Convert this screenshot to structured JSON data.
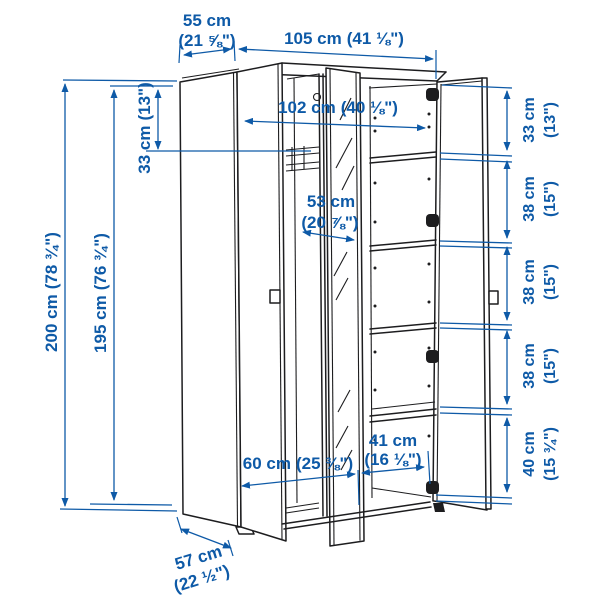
{
  "diagram": {
    "kind": "wardrobe-dimension-diagram",
    "background": "#ffffff",
    "dimension_color": "#0e5aa7",
    "outline_color": "#1d1d1f"
  },
  "dimensions": {
    "top_depth": {
      "cm": "55 cm",
      "inches": "(21 ⅝\")"
    },
    "overall_width": {
      "cm": "105 cm",
      "inches": "(41 ⅛\")"
    },
    "interior_width": {
      "cm": "102 cm",
      "inches": "(40 ⅛\")"
    },
    "top_section_left": {
      "cm": "33 cm",
      "inches": "(13\")"
    },
    "overall_height": {
      "cm": "200 cm",
      "inches": "(78 ¾\")"
    },
    "interior_height": {
      "cm": "195 cm",
      "inches": "(76 ¾\")"
    },
    "mirror_width": {
      "cm": "53 cm",
      "inches": "(20 ⅞\")"
    },
    "left_compartment_width": {
      "cm": "60 cm",
      "inches": "(25 ⅜\")"
    },
    "right_compartment_width": {
      "cm": "41 cm",
      "inches": "(16 ⅛\")"
    },
    "base_depth": {
      "cm": "57 cm",
      "inches": "(22 ½\")"
    },
    "right_sections": [
      {
        "cm": "33 cm",
        "inches": "(13\")"
      },
      {
        "cm": "38 cm",
        "inches": "(15\")"
      },
      {
        "cm": "38 cm",
        "inches": "(15\")"
      },
      {
        "cm": "38 cm",
        "inches": "(15\")"
      },
      {
        "cm": "40 cm",
        "inches": "(15 ¾\")"
      }
    ]
  }
}
